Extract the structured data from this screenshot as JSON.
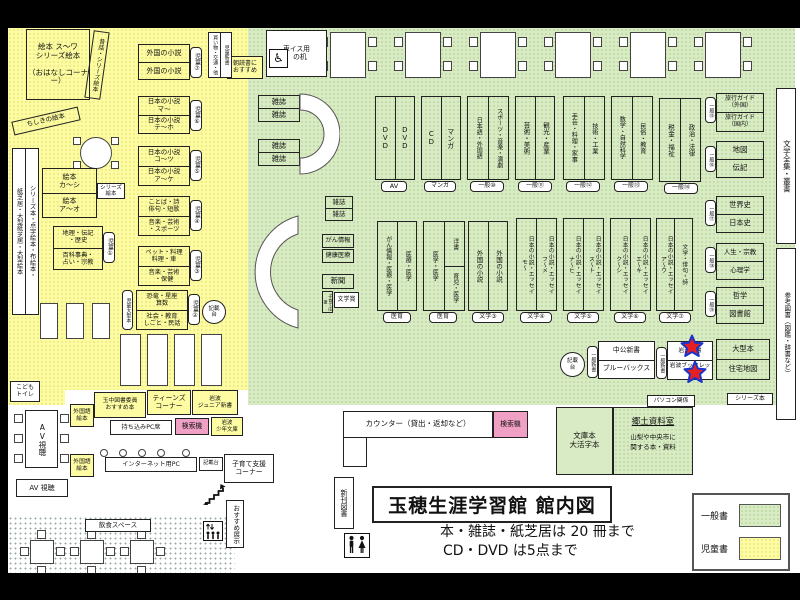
{
  "title": {
    "text": "玉穂生涯学習館 館内図",
    "note1": "本・雑誌・紙芝居は 20 冊まで",
    "note2": "CD・DVD は5点まで"
  },
  "legend": {
    "general": "一般書",
    "children": "児童書",
    "general_color": "#d9ebc4",
    "children_color": "#fdfca3"
  },
  "rooms": {
    "kyodo_title": "郷土資料室",
    "kyodo_body": "山梨や中央市に\n関する本・資料"
  },
  "icons": {
    "wheelchair": "♿"
  },
  "colors": {
    "search_machine": "#f0a0c4",
    "star_fill": "#e62020",
    "star_stroke": "#1a35cc"
  },
  "boxes": [
    {
      "i": "ehon-corner",
      "k": "t",
      "x": 26,
      "y": 29,
      "w": 64,
      "h": 71,
      "f": 7.5,
      "t": "絵本 ス〜ワ\nシリーズ絵本\n\n（おはなしコーナー）"
    },
    {
      "i": "mukashibanashi-label",
      "k": "v",
      "x": 89,
      "y": 31,
      "w": 16,
      "h": 68,
      "f": 6,
      "o": 8,
      "t": "昔話・シリーズ絵本"
    },
    {
      "i": "chishiki-ehon-label",
      "k": "t",
      "x": 12,
      "y": 114,
      "w": 68,
      "h": 14,
      "f": 6.5,
      "o": -13,
      "t": "ちしきの絵本"
    },
    {
      "i": "series-hon-strip",
      "k": "c",
      "x": 12,
      "y": 148,
      "w": 27,
      "h": 167,
      "b": "w",
      "f": 6.2,
      "c": [
        "紙芝居・大型紙芝居・大型絵本",
        "シリーズ本・点字絵本・布絵本・"
      ]
    },
    {
      "i": "ehon-ka-shi",
      "k": "r",
      "x": 42,
      "y": 168,
      "w": 55,
      "h": 50,
      "f": 7,
      "r": [
        "絵本\nカ〜シ",
        "絵本\nア〜オ"
      ]
    },
    {
      "i": "series-ehon-tag",
      "k": "t",
      "x": 97,
      "y": 183,
      "w": 28,
      "h": 16,
      "b": "w",
      "f": 5.5,
      "t": "シリーズ\n絵本"
    },
    {
      "i": "chiri-shelf",
      "k": "r",
      "x": 53,
      "y": 226,
      "w": 50,
      "h": 44,
      "f": 6.2,
      "r": [
        "地理・伝記\n・歴史",
        "百科事典・\n占い・宗教"
      ]
    },
    {
      "i": "tag-jido-1",
      "k": "v",
      "x": 103,
      "y": 232,
      "w": 12,
      "h": 31,
      "b": "w",
      "tag": 1,
      "f": 6,
      "t": "児童①"
    },
    {
      "i": "gaikoku-shosetsu-jido",
      "k": "r",
      "x": 138,
      "y": 44,
      "w": 52,
      "h": 36,
      "f": 7,
      "r": [
        "外国の小説",
        "外国の小説"
      ]
    },
    {
      "i": "tag-jido-7",
      "k": "v",
      "x": 190,
      "y": 47,
      "w": 12,
      "h": 31,
      "b": "w",
      "tag": 1,
      "f": 6,
      "t": "児童⑦"
    },
    {
      "i": "nihon-shosetsu-ma",
      "k": "r",
      "x": 138,
      "y": 96,
      "w": 52,
      "h": 38,
      "f": 6.5,
      "r": [
        "日本の小説\nマ〜",
        "日本の小説\nテ〜ホ"
      ]
    },
    {
      "i": "tag-jido-6",
      "k": "v",
      "x": 190,
      "y": 100,
      "w": 12,
      "h": 31,
      "b": "w",
      "tag": 1,
      "f": 6,
      "t": "児童⑥"
    },
    {
      "i": "nihon-shosetsu-ko",
      "k": "r",
      "x": 138,
      "y": 146,
      "w": 52,
      "h": 40,
      "f": 6.5,
      "r": [
        "日本の小説\nコ〜ツ",
        "日本の小説\nア〜ケ"
      ]
    },
    {
      "i": "tag-jido-5",
      "k": "v",
      "x": 190,
      "y": 150,
      "w": 12,
      "h": 31,
      "b": "w",
      "tag": 1,
      "f": 6,
      "t": "児童⑤"
    },
    {
      "i": "kotoba-shelf",
      "k": "r",
      "x": 138,
      "y": 196,
      "w": 52,
      "h": 40,
      "f": 6.2,
      "r": [
        "ことば・詩\n俳句・短歌",
        "音楽・芸術\n・スポーツ"
      ]
    },
    {
      "i": "tag-jido-4",
      "k": "v",
      "x": 190,
      "y": 200,
      "w": 12,
      "h": 31,
      "b": "w",
      "tag": 1,
      "f": 6,
      "t": "児童④"
    },
    {
      "i": "pet-shelf",
      "k": "r",
      "x": 138,
      "y": 246,
      "w": 52,
      "h": 40,
      "f": 6.2,
      "r": [
        "ペット・料理\n料理・車",
        "音楽・芸術\n・保健"
      ]
    },
    {
      "i": "tag-jido-3",
      "k": "v",
      "x": 190,
      "y": 250,
      "w": 12,
      "h": 31,
      "b": "w",
      "tag": 1,
      "f": 6,
      "t": "児童③"
    },
    {
      "i": "kyoryu-shelf",
      "k": "r",
      "x": 136,
      "y": 290,
      "w": 52,
      "h": 40,
      "f": 6.2,
      "r": [
        "恐竜・星座\n算数",
        "社会・教育\nしごと・民話"
      ]
    },
    {
      "i": "tag-jido-2",
      "k": "v",
      "x": 188,
      "y": 294,
      "w": 12,
      "h": 31,
      "b": "w",
      "tag": 1,
      "f": 6,
      "t": "児童②"
    },
    {
      "i": "tag-jido-ogata",
      "k": "v",
      "x": 122,
      "y": 290,
      "w": 11,
      "h": 40,
      "b": "w",
      "tag": 1,
      "f": 5,
      "t": "児童大型本"
    },
    {
      "i": "kisaidai-jido",
      "k": "t",
      "x": 202,
      "y": 300,
      "w": 24,
      "h": 24,
      "b": "w",
      "round": 1,
      "f": 5.5,
      "t": "記載\n台"
    },
    {
      "i": "kodomo-toilet",
      "k": "t",
      "x": 10,
      "y": 381,
      "w": 30,
      "h": 21,
      "b": "w",
      "f": 6,
      "t": "こども\nトイレ"
    },
    {
      "i": "gaikokugo-ehon-1",
      "k": "t",
      "x": 70,
      "y": 404,
      "w": 24,
      "h": 23,
      "b": "y",
      "f": 5.8,
      "t": "外国語\n絵本"
    },
    {
      "i": "tamaho-osusume",
      "k": "t",
      "x": 94,
      "y": 392,
      "w": 52,
      "h": 26,
      "b": "y",
      "f": 5.8,
      "t": "玉中図書委員\nおすすめ本"
    },
    {
      "i": "teens-corner",
      "k": "t",
      "x": 147,
      "y": 390,
      "w": 44,
      "h": 25,
      "b": "y",
      "f": 6.8,
      "t": "ティーンズ\nコーナー"
    },
    {
      "i": "iwanami-junior-shinsho",
      "k": "t",
      "x": 192,
      "y": 390,
      "w": 46,
      "h": 25,
      "b": "y",
      "f": 5.8,
      "t": "岩波\nジュニア新書"
    },
    {
      "i": "mochikomi-pc-seki",
      "k": "t",
      "x": 110,
      "y": 420,
      "w": 62,
      "h": 15,
      "b": "w",
      "f": 6.2,
      "t": "持ち込みPC席"
    },
    {
      "i": "kensakuki-teens",
      "k": "t",
      "x": 175,
      "y": 418,
      "w": 34,
      "h": 17,
      "b": "p",
      "f": 6.8,
      "t": "検索機"
    },
    {
      "i": "iwanami-shonen-bunko",
      "k": "t",
      "x": 211,
      "y": 417,
      "w": 32,
      "h": 19,
      "b": "y",
      "f": 5.4,
      "t": "岩波\n少年文庫"
    },
    {
      "i": "av-shicho-table",
      "k": "v",
      "x": 25,
      "y": 410,
      "w": 33,
      "h": 58,
      "b": "w",
      "f": 7.5,
      "t": "AV視聴"
    },
    {
      "i": "gaikokugo-ehon-2",
      "k": "t",
      "x": 70,
      "y": 454,
      "w": 24,
      "h": 23,
      "b": "y",
      "f": 5.8,
      "t": "外国語\n絵本"
    },
    {
      "i": "internet-pc",
      "k": "t",
      "x": 105,
      "y": 457,
      "w": 92,
      "h": 15,
      "b": "w",
      "f": 6.2,
      "t": "インターネット用PC"
    },
    {
      "i": "kisaidai-pc",
      "k": "t",
      "x": 199,
      "y": 457,
      "w": 24,
      "h": 14,
      "b": "w",
      "f": 5.2,
      "t": "記載台"
    },
    {
      "i": "kosodate-shien-corner",
      "k": "t",
      "x": 224,
      "y": 454,
      "w": 50,
      "h": 29,
      "b": "w",
      "f": 6.8,
      "t": "子育て支援\nコーナー"
    },
    {
      "i": "av-shicho-2",
      "k": "t",
      "x": 16,
      "y": 479,
      "w": 52,
      "h": 18,
      "b": "w",
      "f": 7,
      "t": "AV 視聴"
    },
    {
      "i": "osusume-tenji",
      "k": "v",
      "x": 226,
      "y": 500,
      "w": 18,
      "h": 48,
      "b": "w",
      "f": 6.5,
      "t": "おすすめ展示"
    },
    {
      "i": "inshoku-label",
      "k": "t",
      "x": 85,
      "y": 519,
      "w": 66,
      "h": 13,
      "b": "w",
      "f": 6.5,
      "t": "飲食スペース"
    },
    {
      "i": "kurumaisu-desk",
      "k": "t",
      "x": 266,
      "y": 30,
      "w": 61,
      "h": 47,
      "b": "w",
      "f": 6.8,
      "t": "車イス用\n　の机"
    },
    {
      "i": "asadoku-osusume",
      "k": "t",
      "x": 227,
      "y": 56,
      "w": 36,
      "h": 23,
      "b": "y",
      "f": 6,
      "t": "朝読書に\nおすすめ"
    },
    {
      "i": "jido-shinsho",
      "k": "c",
      "x": 208,
      "y": 32,
      "w": 24,
      "h": 46,
      "b": "w",
      "f": 5,
      "c": [
        "買い物・交通・他",
        "児童新書"
      ]
    },
    {
      "i": "zasshi-a",
      "k": "r",
      "x": 258,
      "y": 95,
      "w": 42,
      "h": 27,
      "f": 7.2,
      "r": [
        "雑誌",
        "雑誌"
      ]
    },
    {
      "i": "zasshi-b",
      "k": "r",
      "x": 258,
      "y": 139,
      "w": 42,
      "h": 27,
      "f": 7.2,
      "r": [
        "雑誌",
        "雑誌"
      ]
    },
    {
      "i": "zasshi-c",
      "k": "r",
      "x": 325,
      "y": 196,
      "w": 28,
      "h": 25,
      "f": 6.5,
      "r": [
        "雑誌",
        "雑誌"
      ]
    },
    {
      "i": "gan-joho",
      "k": "t",
      "x": 322,
      "y": 234,
      "w": 32,
      "h": 14,
      "f": 6.2,
      "t": "がん情報"
    },
    {
      "i": "kenko-iryo",
      "k": "t",
      "x": 322,
      "y": 249,
      "w": 32,
      "h": 14,
      "f": 6.2,
      "t": "健康医療"
    },
    {
      "i": "shinbun",
      "k": "t",
      "x": 322,
      "y": 274,
      "w": 32,
      "h": 15,
      "f": 7.2,
      "t": "新聞"
    },
    {
      "i": "kosodate-ouen",
      "k": "v",
      "x": 322,
      "y": 291,
      "w": 11,
      "h": 22,
      "f": 4.2,
      "t": "子育て応援"
    },
    {
      "i": "bungaku-sho",
      "k": "t",
      "x": 334,
      "y": 292,
      "w": 25,
      "h": 16,
      "b": "w",
      "f": 6,
      "t": "文学賞"
    },
    {
      "i": "dvd-shelf",
      "k": "c",
      "x": 375,
      "y": 96,
      "w": 40,
      "h": 84,
      "f": 7,
      "c": [
        "DVD",
        "DVD"
      ]
    },
    {
      "i": "tag-av",
      "k": "t",
      "x": 381,
      "y": 181,
      "w": 26,
      "h": 11,
      "b": "w",
      "tag": 1,
      "f": 6.5,
      "t": "AV"
    },
    {
      "i": "cd-manga-shelf",
      "k": "c",
      "x": 421,
      "y": 96,
      "w": 40,
      "h": 84,
      "f": 7,
      "c": [
        "CD",
        "マンガ"
      ]
    },
    {
      "i": "tag-manga",
      "k": "t",
      "x": 424,
      "y": 181,
      "w": 32,
      "h": 11,
      "b": "w",
      "tag": 1,
      "f": 6,
      "t": "マンガ"
    },
    {
      "i": "shelf-ippan-10",
      "k": "c",
      "x": 467,
      "y": 96,
      "w": 42,
      "h": 84,
      "f": 6,
      "c": [
        "日本語・外国語",
        "スポーツ・音楽・演劇"
      ]
    },
    {
      "i": "tag-ippan-10",
      "k": "t",
      "x": 470,
      "y": 181,
      "w": 34,
      "h": 11,
      "b": "w",
      "tag": 1,
      "f": 6,
      "t": "一般⑩"
    },
    {
      "i": "shelf-ippan-11",
      "k": "c",
      "x": 515,
      "y": 96,
      "w": 40,
      "h": 84,
      "f": 6.5,
      "c": [
        "芸術・美術",
        "観光・産業"
      ]
    },
    {
      "i": "tag-ippan-11",
      "k": "t",
      "x": 518,
      "y": 181,
      "w": 34,
      "h": 11,
      "b": "w",
      "tag": 1,
      "f": 6,
      "t": "一般⑪"
    },
    {
      "i": "shelf-ippan-12",
      "k": "c",
      "x": 563,
      "y": 96,
      "w": 42,
      "h": 84,
      "f": 6.2,
      "c": [
        "手芸・料理・家事",
        "技術・工業"
      ]
    },
    {
      "i": "tag-ippan-12",
      "k": "t",
      "x": 566,
      "y": 181,
      "w": 34,
      "h": 11,
      "b": "w",
      "tag": 1,
      "f": 6,
      "t": "一般⑫"
    },
    {
      "i": "shelf-ippan-13",
      "k": "c",
      "x": 611,
      "y": 96,
      "w": 42,
      "h": 84,
      "f": 6.2,
      "c": [
        "数学・自然科学",
        "民俗・教育"
      ]
    },
    {
      "i": "tag-ippan-13",
      "k": "t",
      "x": 614,
      "y": 181,
      "w": 34,
      "h": 11,
      "b": "w",
      "tag": 1,
      "f": 6,
      "t": "一般⑬"
    },
    {
      "i": "shelf-ippan-14",
      "k": "c",
      "x": 659,
      "y": 98,
      "w": 42,
      "h": 84,
      "f": 6.5,
      "c": [
        "税金・福祉",
        "政治・法律"
      ]
    },
    {
      "i": "tag-ippan-14",
      "k": "t",
      "x": 664,
      "y": 183,
      "w": 34,
      "h": 11,
      "b": "w",
      "tag": 1,
      "f": 6,
      "t": "一般⑭"
    },
    {
      "i": "med-shelf-1",
      "k": "c",
      "x": 377,
      "y": 221,
      "w": 40,
      "h": 90,
      "f": 6,
      "c": [
        "がん情報・医療・医学",
        "医療・医学"
      ]
    },
    {
      "i": "tag-iiku-1",
      "k": "t",
      "x": 383,
      "y": 312,
      "w": 28,
      "h": 11,
      "b": "w",
      "tag": 1,
      "f": 6,
      "t": "医育"
    },
    {
      "i": "med-shelf-2",
      "k": "c",
      "x": 423,
      "y": 221,
      "w": 42,
      "h": 90,
      "f": 6,
      "c": [
        "医学・医学",
        "洋書|育児・医学"
      ]
    },
    {
      "i": "tag-iiku-2",
      "k": "t",
      "x": 429,
      "y": 312,
      "w": 28,
      "h": 11,
      "b": "w",
      "tag": 1,
      "f": 6,
      "t": "医育"
    },
    {
      "i": "shelf-bungaku-3",
      "k": "c",
      "x": 468,
      "y": 221,
      "w": 40,
      "h": 90,
      "f": 6.5,
      "c": [
        "外国の小説",
        "外国の小説"
      ]
    },
    {
      "i": "tag-bungaku-3",
      "k": "t",
      "x": 472,
      "y": 312,
      "w": 32,
      "h": 11,
      "b": "w",
      "tag": 1,
      "f": 6,
      "t": "文学③"
    },
    {
      "i": "shelf-bungaku-4",
      "k": "c",
      "x": 516,
      "y": 218,
      "w": 41,
      "h": 93,
      "f": 5.8,
      "c": [
        "日本の小説・エッセイ\nモ〜",
        "日本の小説・エッセイ\nフ〜メ"
      ]
    },
    {
      "i": "tag-bungaku-4",
      "k": "t",
      "x": 520,
      "y": 312,
      "w": 32,
      "h": 11,
      "b": "w",
      "tag": 1,
      "f": 6,
      "t": "文学④"
    },
    {
      "i": "shelf-bungaku-5",
      "k": "c",
      "x": 563,
      "y": 218,
      "w": 41,
      "h": 93,
      "f": 5.8,
      "c": [
        "日本の小説・エッセイ\nナ〜ヒ",
        "日本の小説・エッセイ\nス〜ト"
      ]
    },
    {
      "i": "tag-bungaku-5",
      "k": "t",
      "x": 567,
      "y": 312,
      "w": 32,
      "h": 11,
      "b": "w",
      "tag": 1,
      "f": 6,
      "t": "文学⑤"
    },
    {
      "i": "shelf-bungaku-6",
      "k": "c",
      "x": 610,
      "y": 218,
      "w": 41,
      "h": 93,
      "f": 5.8,
      "c": [
        "日本の小説・エッセイ\nク〜シ",
        "日本の小説・エッセイ\nエ〜キ"
      ]
    },
    {
      "i": "tag-bungaku-6",
      "k": "t",
      "x": 614,
      "y": 312,
      "w": 32,
      "h": 11,
      "b": "w",
      "tag": 1,
      "f": 6,
      "t": "文学⑥"
    },
    {
      "i": "shelf-bungaku-7",
      "k": "c",
      "x": 656,
      "y": 218,
      "w": 37,
      "h": 93,
      "f": 5.8,
      "c": [
        "日本の小説・エッセイ\nア〜ウ",
        "文学・俳句・詩"
      ]
    },
    {
      "i": "tag-bungaku-7",
      "k": "t",
      "x": 659,
      "y": 312,
      "w": 32,
      "h": 11,
      "b": "w",
      "tag": 1,
      "f": 6,
      "t": "文学⑦"
    },
    {
      "i": "ryokou-guide-shelf",
      "k": "r",
      "x": 716,
      "y": 93,
      "w": 48,
      "h": 39,
      "f": 6,
      "r": [
        "旅行ガイド\n（外国）",
        "旅行ガイド\n（国内）"
      ]
    },
    {
      "i": "tag-ippan-15",
      "k": "v",
      "x": 705,
      "y": 97,
      "w": 11,
      "h": 26,
      "b": "w",
      "tag": 1,
      "f": 5,
      "t": "一般⑮"
    },
    {
      "i": "chizu-denki-shelf",
      "k": "r",
      "x": 716,
      "y": 141,
      "w": 48,
      "h": 37,
      "f": 7.5,
      "r": [
        "地図",
        "伝記"
      ]
    },
    {
      "i": "tag-ippan-16",
      "k": "v",
      "x": 705,
      "y": 146,
      "w": 11,
      "h": 26,
      "b": "w",
      "tag": 1,
      "f": 5,
      "t": "一般⑯"
    },
    {
      "i": "sekaishi-shelf",
      "k": "r",
      "x": 716,
      "y": 196,
      "w": 48,
      "h": 37,
      "f": 7.2,
      "r": [
        "世界史",
        "日本史"
      ]
    },
    {
      "i": "tag-ippan-17",
      "k": "v",
      "x": 705,
      "y": 200,
      "w": 11,
      "h": 26,
      "b": "w",
      "tag": 1,
      "f": 5,
      "t": "一般⑰"
    },
    {
      "i": "jinsei-shelf",
      "k": "r",
      "x": 716,
      "y": 243,
      "w": 48,
      "h": 37,
      "f": 6.5,
      "r": [
        "人生・宗教",
        "心理学"
      ]
    },
    {
      "i": "tag-ippan-18",
      "k": "v",
      "x": 705,
      "y": 247,
      "w": 11,
      "h": 26,
      "b": "w",
      "tag": 1,
      "f": 5,
      "t": "一般⑱"
    },
    {
      "i": "tetsugaku-shelf",
      "k": "r",
      "x": 716,
      "y": 287,
      "w": 48,
      "h": 37,
      "f": 7.2,
      "r": [
        "哲学",
        "図書館"
      ]
    },
    {
      "i": "tag-ippan-19",
      "k": "v",
      "x": 705,
      "y": 291,
      "w": 11,
      "h": 26,
      "b": "w",
      "tag": 1,
      "f": 5,
      "t": "一般⑲"
    },
    {
      "i": "bungaku-zenshu-strip",
      "k": "v",
      "x": 776,
      "y": 88,
      "w": 20,
      "h": 156,
      "b": "w",
      "f": 7.5,
      "t": "文学全集・叢書"
    },
    {
      "i": "sanko-tosho-strip",
      "k": "v",
      "x": 776,
      "y": 248,
      "w": 20,
      "h": 172,
      "b": "w",
      "f": 6.5,
      "t": "参考図書（図鑑・辞書など）"
    },
    {
      "i": "kisaidai-shinsho",
      "k": "t",
      "x": 560,
      "y": 352,
      "w": 25,
      "h": 25,
      "b": "w",
      "round": 1,
      "f": 5.5,
      "t": "記載\n台"
    },
    {
      "i": "tag-ippan-shinsho-1",
      "k": "v",
      "x": 587,
      "y": 346,
      "w": 11,
      "h": 32,
      "b": "w",
      "tag": 1,
      "f": 5,
      "t": "一般新書"
    },
    {
      "i": "chuko-shinsho-shelf",
      "k": "r",
      "x": 598,
      "y": 341,
      "w": 57,
      "h": 38,
      "b": "w",
      "f": 6.8,
      "r": [
        "中公新書",
        "ブルーバックス"
      ]
    },
    {
      "i": "tag-ippan-shinsho-2",
      "k": "v",
      "x": 656,
      "y": 347,
      "w": 11,
      "h": 32,
      "b": "w",
      "tag": 1,
      "f": 5,
      "t": "一般新書"
    },
    {
      "i": "iwanami-shinsho-shelf",
      "k": "r",
      "x": 667,
      "y": 341,
      "w": 46,
      "h": 39,
      "b": "w",
      "f": 5.8,
      "r": [
        "岩波新書",
        "岩波ブックレット"
      ]
    },
    {
      "i": "ogata-bon-shelf",
      "k": "r",
      "x": 716,
      "y": 339,
      "w": 54,
      "h": 41,
      "f": 7.2,
      "r": [
        "大型本",
        "住宅地図"
      ]
    },
    {
      "i": "tag-series-bon",
      "k": "t",
      "x": 727,
      "y": 393,
      "w": 46,
      "h": 12,
      "b": "w",
      "f": 6,
      "t": "シリーズ本"
    },
    {
      "i": "tag-pasokon",
      "k": "t",
      "x": 647,
      "y": 395,
      "w": 48,
      "h": 12,
      "b": "w",
      "f": 5.8,
      "t": "パソコン関係"
    },
    {
      "i": "counter",
      "k": "t",
      "x": 343,
      "y": 411,
      "w": 150,
      "h": 27,
      "b": "w",
      "f": 7.5,
      "t": "カウンター（貸出・返却など）"
    },
    {
      "i": "kensakuki-counter",
      "k": "t",
      "x": 493,
      "y": 411,
      "w": 35,
      "h": 27,
      "b": "p",
      "f": 6.8,
      "t": "検索機"
    },
    {
      "i": "counter-leg",
      "k": "t",
      "x": 343,
      "y": 437,
      "w": 24,
      "h": 30,
      "b": "w",
      "f": 6,
      "t": ""
    },
    {
      "i": "shinkan-tosho",
      "k": "v",
      "x": 334,
      "y": 477,
      "w": 20,
      "h": 52,
      "b": "w",
      "f": 7,
      "t": "新刊図書"
    },
    {
      "i": "bunko-daikatsuji",
      "k": "t",
      "x": 556,
      "y": 407,
      "w": 57,
      "h": 68,
      "b": "g",
      "f": 7.5,
      "t": "文庫本\n大活字本"
    }
  ]
}
